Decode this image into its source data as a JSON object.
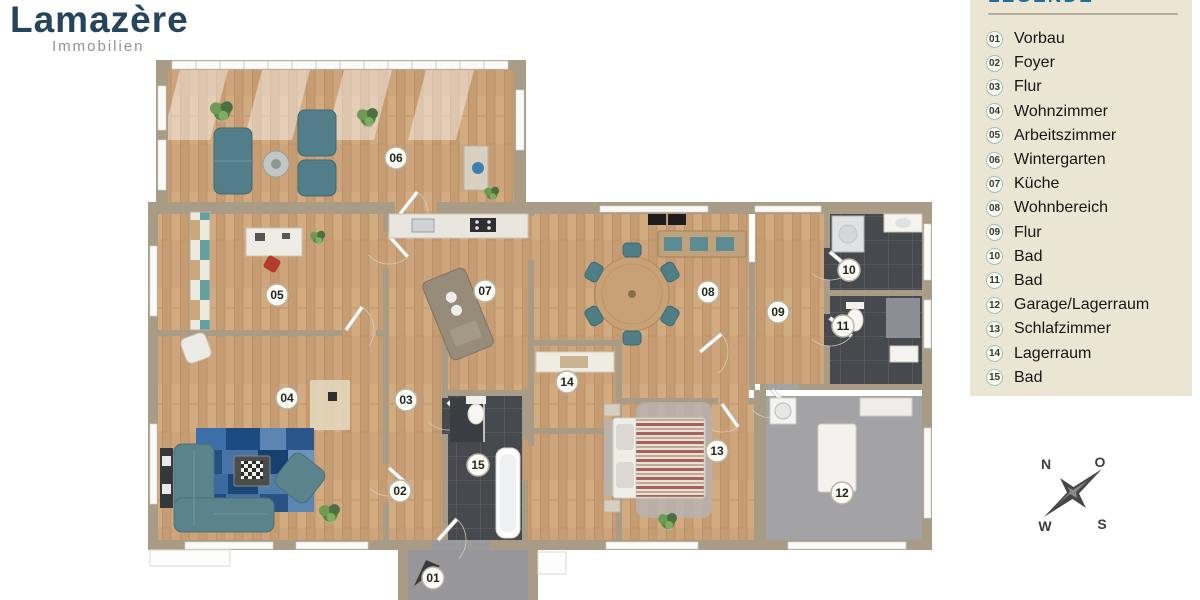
{
  "brand": {
    "name": "Lamazère",
    "tagline": "Immobilien"
  },
  "legend": {
    "title": "LEGENDE",
    "items": [
      {
        "number": "01",
        "label": "Vorbau"
      },
      {
        "number": "02",
        "label": "Foyer"
      },
      {
        "number": "03",
        "label": "Flur"
      },
      {
        "number": "04",
        "label": "Wohnzimmer"
      },
      {
        "number": "05",
        "label": "Arbeitszimmer"
      },
      {
        "number": "06",
        "label": "Wintergarten"
      },
      {
        "number": "07",
        "label": "Küche"
      },
      {
        "number": "08",
        "label": "Wohnbereich"
      },
      {
        "number": "09",
        "label": "Flur"
      },
      {
        "number": "10",
        "label": "Bad"
      },
      {
        "number": "11",
        "label": "Bad"
      },
      {
        "number": "12",
        "label": "Garage/Lagerraum"
      },
      {
        "number": "13",
        "label": "Schlafzimmer"
      },
      {
        "number": "14",
        "label": "Lagerraum"
      },
      {
        "number": "15",
        "label": "Bad"
      }
    ]
  },
  "plan": {
    "badges": [
      {
        "number": "01",
        "x": 433,
        "y": 578
      },
      {
        "number": "02",
        "x": 400,
        "y": 491
      },
      {
        "number": "03",
        "x": 406,
        "y": 400
      },
      {
        "number": "04",
        "x": 287,
        "y": 398
      },
      {
        "number": "05",
        "x": 277,
        "y": 295
      },
      {
        "number": "06",
        "x": 396,
        "y": 158
      },
      {
        "number": "07",
        "x": 485,
        "y": 291
      },
      {
        "number": "08",
        "x": 708,
        "y": 292
      },
      {
        "number": "09",
        "x": 778,
        "y": 312
      },
      {
        "number": "10",
        "x": 849,
        "y": 270
      },
      {
        "number": "11",
        "x": 843,
        "y": 326
      },
      {
        "number": "12",
        "x": 842,
        "y": 493
      },
      {
        "number": "13",
        "x": 717,
        "y": 451
      },
      {
        "number": "14",
        "x": 567,
        "y": 382
      },
      {
        "number": "15",
        "x": 478,
        "y": 465
      }
    ]
  },
  "compass": {
    "n": "N",
    "e": "O",
    "s": "S",
    "w": "W"
  },
  "colors": {
    "wood_floor": "#cda47b",
    "wall": "#a99c86",
    "bath_tile": "#46494d",
    "garage_floor": "#a3a3a5",
    "sofa_teal": "#517e89",
    "rug_blue": "#2f5d96",
    "legend_background": "#ebe5d4",
    "legend_heading_blue": "#1e6f9c",
    "logo_blue": "#24455c"
  }
}
